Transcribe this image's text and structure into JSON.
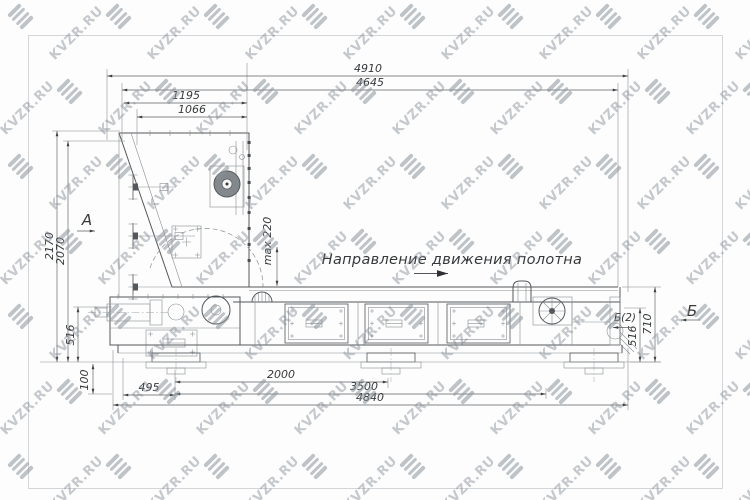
{
  "watermark": {
    "text": "KVZR.RU"
  },
  "annotations": {
    "direction": "Направление движения полотна",
    "section_a": "А",
    "section_b": "Б",
    "section_b2": "Б(2)",
    "max_gap": "max 220"
  },
  "dimensions": {
    "top": {
      "overall": "4910",
      "body": "4645",
      "head_outer": "1195",
      "head_inner": "1066"
    },
    "left": {
      "height_overall": "2170",
      "height_body": "2070",
      "base": "516",
      "floor": "100"
    },
    "right": {
      "outlet_height": "710",
      "base": "516"
    },
    "bottom": {
      "leg_offset": "495",
      "leg_span": "2000",
      "frame_span": "3500",
      "overall": "4840"
    }
  }
}
